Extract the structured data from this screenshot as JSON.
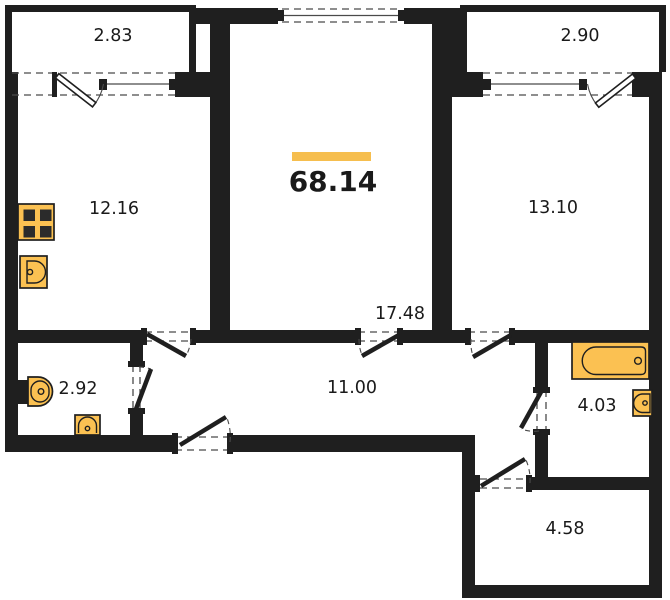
{
  "floor_plan": {
    "total_area": {
      "label": "68.14"
    },
    "rooms": [
      {
        "name": "balcony-left",
        "area_label": "2.83"
      },
      {
        "name": "balcony-right",
        "area_label": "2.90"
      },
      {
        "name": "kitchen",
        "area_label": "12.16"
      },
      {
        "name": "living-room",
        "area_label": "17.48"
      },
      {
        "name": "bedroom",
        "area_label": "13.10"
      },
      {
        "name": "wc",
        "area_label": "2.92"
      },
      {
        "name": "corridor",
        "area_label": "11.00"
      },
      {
        "name": "bathroom",
        "area_label": "4.03"
      },
      {
        "name": "hall",
        "area_label": "4.58"
      }
    ],
    "fixtures": [
      {
        "name": "stove-icon"
      },
      {
        "name": "kitchen-sink-icon"
      },
      {
        "name": "toilet-icon"
      },
      {
        "name": "wc-sink-icon"
      },
      {
        "name": "bathtub-icon"
      },
      {
        "name": "bathroom-sink-icon"
      }
    ],
    "colors": {
      "wall": "#1f1f1f",
      "accent": "#F6BE4E",
      "fixture": "#FBC152",
      "fixture_stroke": "#1f1f1f",
      "background": "#ffffff",
      "text": "#1a1a1a",
      "thin_line": "#4a4a4a"
    }
  }
}
